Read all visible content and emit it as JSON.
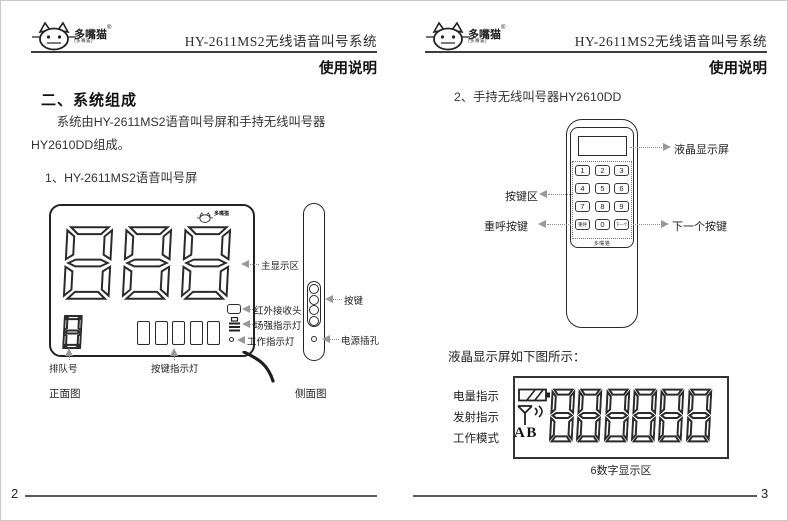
{
  "brand": {
    "name": "多嘴猫",
    "reg": "®",
    "subtext": "(多嘴猫)"
  },
  "header": {
    "title": "HY-2611MS2无线语音叫号系统",
    "subtitle": "使用说明"
  },
  "left_page": {
    "page_number": "2",
    "section_heading": "二、系统组成",
    "paragraph": "系统由HY-2611MS2语音叫号屏和手持无线叫号器HY2610DD组成。",
    "item_heading": "1、HY-2611MS2语音叫号屏",
    "front_view": {
      "main_display_value": "888",
      "queue_value": "8",
      "label_main_display": "主显示区",
      "label_ir": "红外接收头",
      "label_signal": "场强指示灯",
      "label_work": "工作指示灯",
      "label_queue": "排队号",
      "label_key_leds": "按键指示灯",
      "caption": "正面图"
    },
    "side_view": {
      "label_buttons": "按键",
      "label_power": "电源插孔",
      "caption": "侧面图"
    }
  },
  "right_page": {
    "page_number": "3",
    "item_heading": "2、手持无线叫号器HY2610DD",
    "remote": {
      "keys": [
        "1",
        "2",
        "3",
        "4",
        "5",
        "6",
        "7",
        "8",
        "9",
        "重呼",
        "0",
        "下一个"
      ],
      "label_lcd": "液晶显示屏",
      "label_keypad": "按键区",
      "label_recall": "重呼按键",
      "label_next": "下一个按键"
    },
    "lcd_detail": {
      "intro": "液晶显示屏如下图所示：",
      "display_value": "888888",
      "mode_letters": "AB",
      "label_battery": "电量指示",
      "label_transmit": "发射指示",
      "label_mode": "工作模式",
      "caption": "6数字显示区"
    }
  }
}
